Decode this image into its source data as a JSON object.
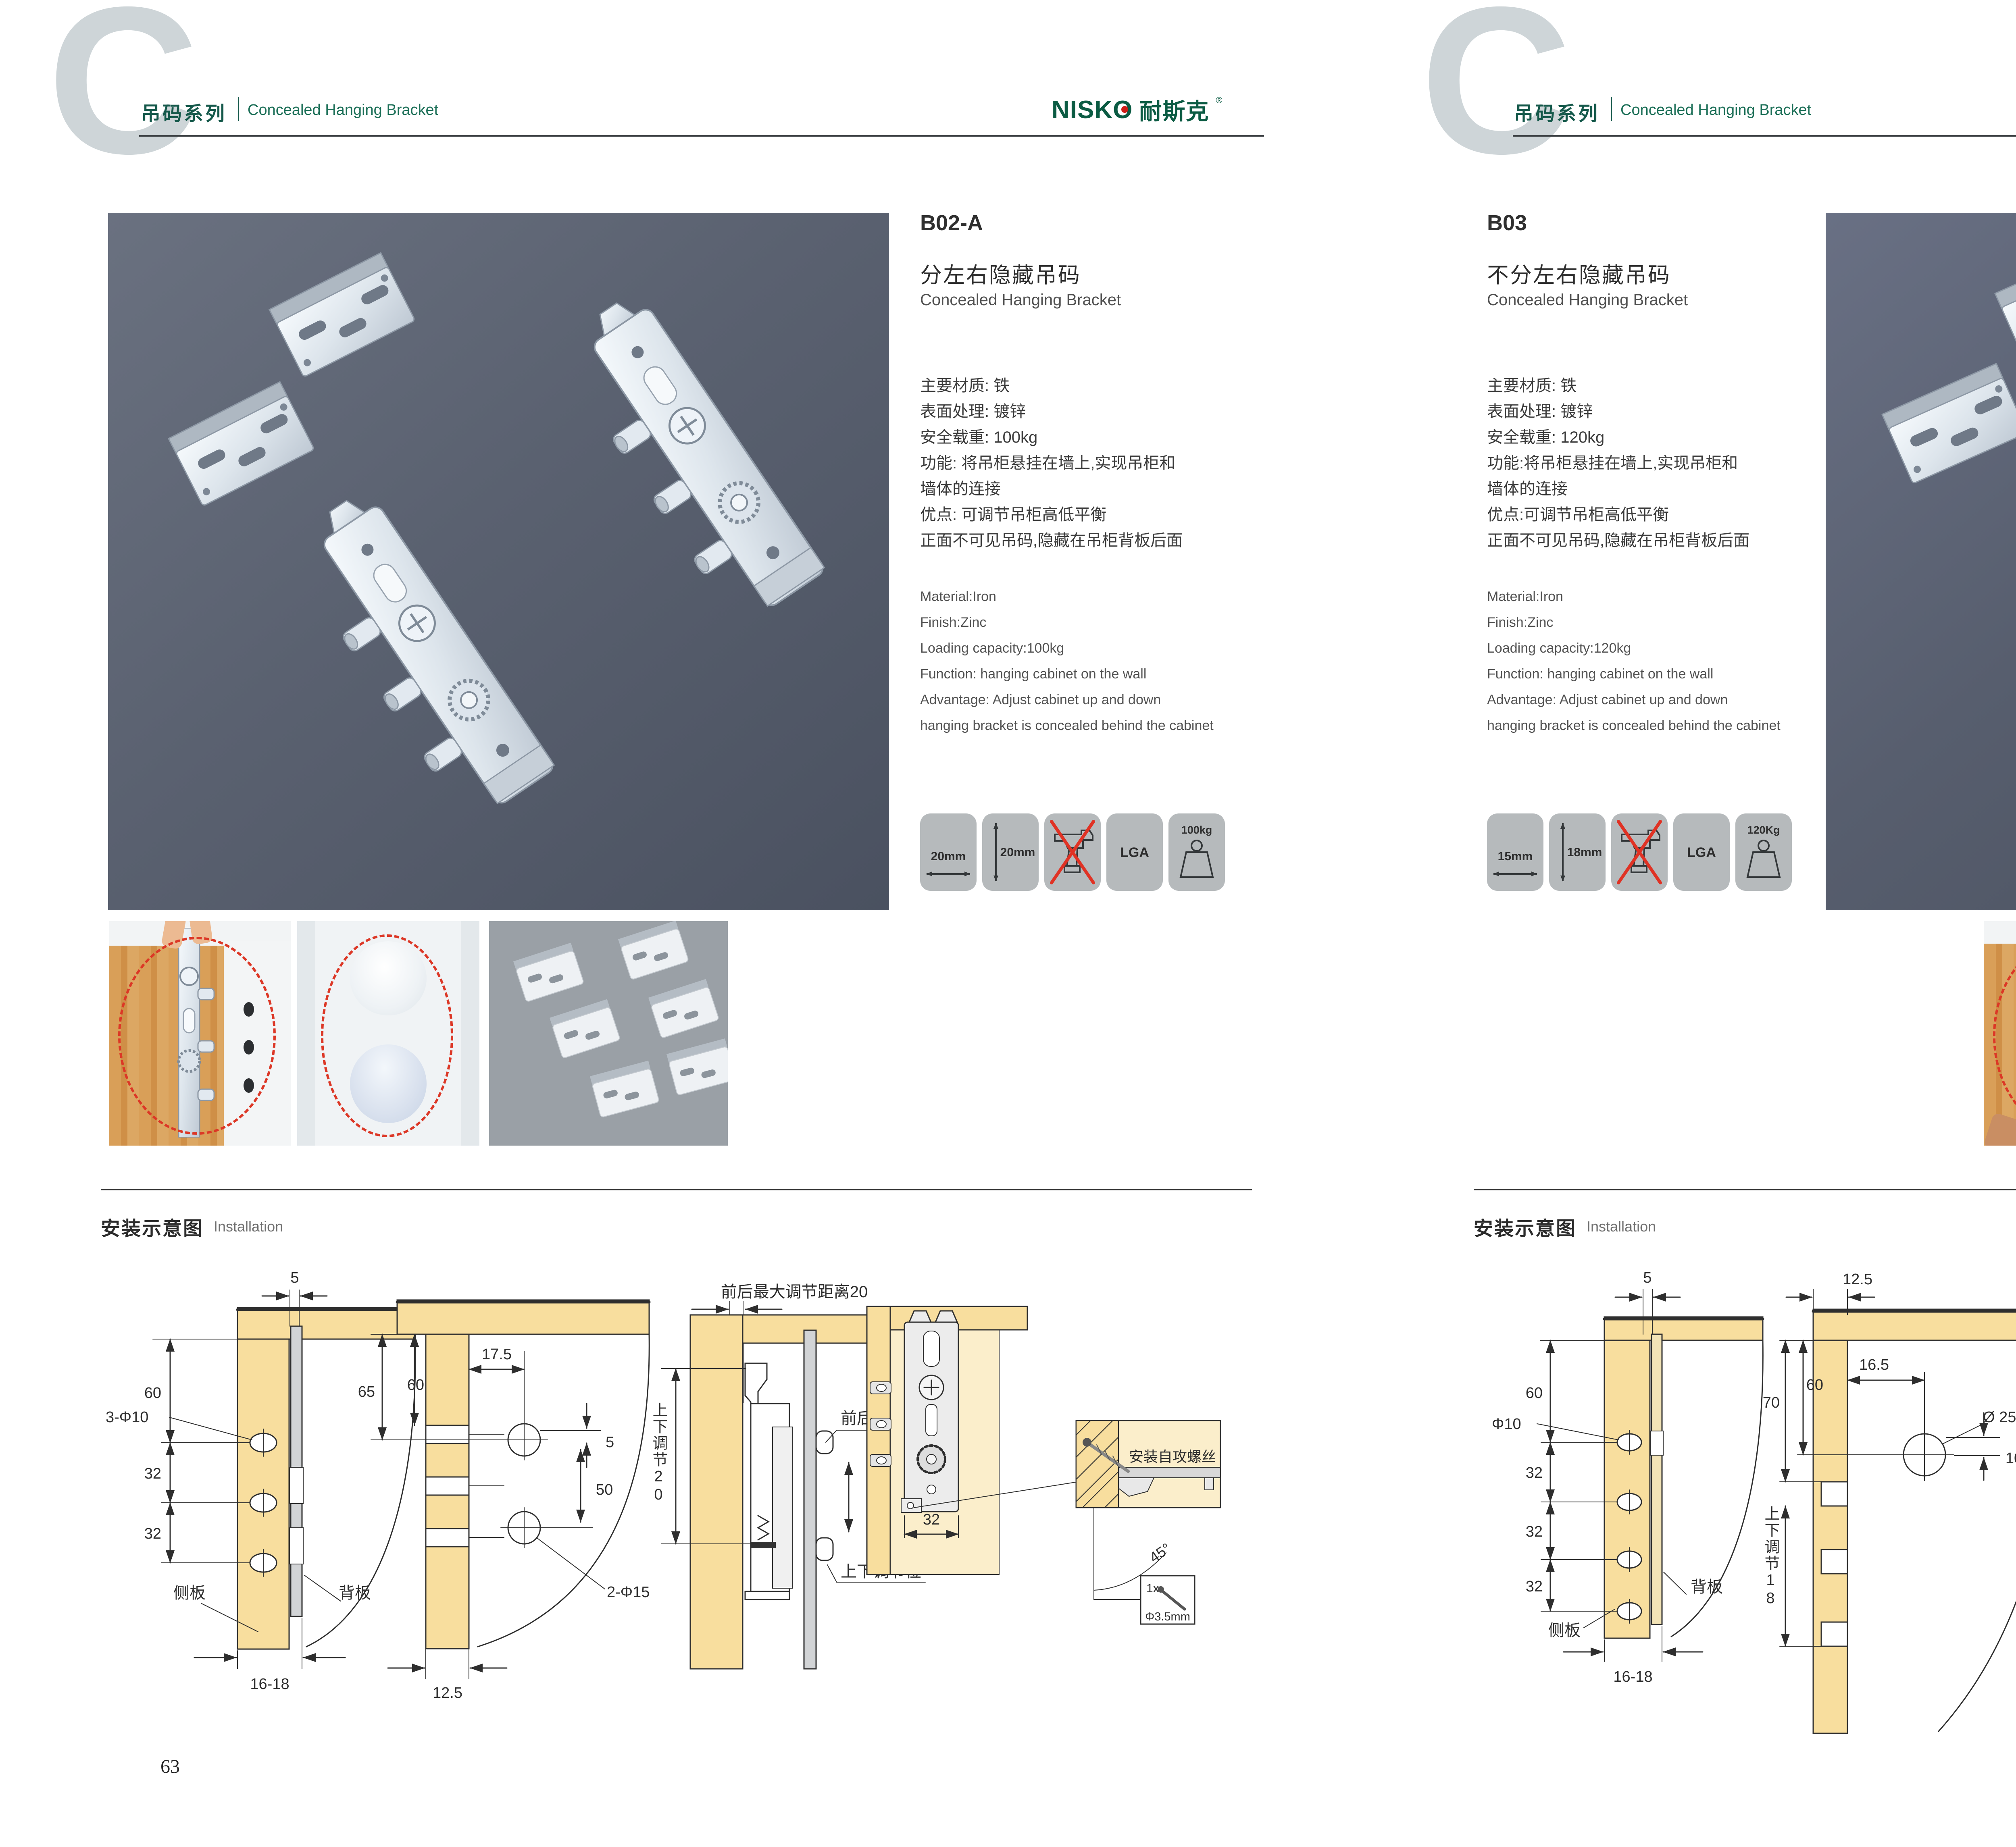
{
  "brand": {
    "logo_en": "NISKO",
    "logo_cn": "耐斯克",
    "reg": "®"
  },
  "header": {
    "letter": "C",
    "series_cn": "吊码系列",
    "series_en": "Concealed Hanging Bracket"
  },
  "install": {
    "title_cn": "安装示意图",
    "title_en": "Installation"
  },
  "left": {
    "page_number": "63",
    "model": "B02-A",
    "title_cn": "分左右隐藏吊码",
    "title_en": "Concealed Hanging Bracket",
    "specs_cn": [
      "主要材质: 铁",
      "表面处理: 镀锌",
      "安全载重: 100kg",
      "功能: 将吊柜悬挂在墙上,实现吊柜和",
      "墙体的连接",
      "优点: 可调节吊柜高低平衡",
      "正面不可见吊码,隐藏在吊柜背板后面"
    ],
    "specs_en": [
      "Material:Iron",
      "Finish:Zinc",
      "Loading capacity:100kg",
      "Function: hanging cabinet on the wall",
      "Advantage: Adjust cabinet up and down",
      "hanging bracket is concealed behind the cabinet"
    ],
    "icon_width": "20mm",
    "icon_height": "20mm",
    "icon_cert": "LGA",
    "icon_load": "100kg",
    "d1": {
      "top": "5",
      "h60": "60",
      "hole": "3-Φ10",
      "s1": "32",
      "s2": "32",
      "bottom": "16-18",
      "side": "侧板",
      "back": "背板"
    },
    "d2": {
      "h65": "65",
      "h60": "60",
      "w175": "17.5",
      "off5": "5",
      "h50": "50",
      "hole": "2-Φ15",
      "bottom": "12.5"
    },
    "d3": {
      "top": "前后最大调节距离20",
      "left": "上下调节20",
      "front": "前后调节位",
      "updown": "上下调节位"
    },
    "d4": {
      "w32": "32",
      "screw": "安装自攻螺丝",
      "angle": "45°",
      "qty": "1x",
      "dia": "Φ3.5mm"
    }
  },
  "right": {
    "page_number": "64",
    "model": "B03",
    "title_cn": "不分左右隐藏吊码",
    "title_en": "Concealed Hanging Bracket",
    "specs_cn": [
      "主要材质: 铁",
      "表面处理: 镀锌",
      "安全载重: 120kg",
      "功能:将吊柜悬挂在墙上,实现吊柜和",
      "墙体的连接",
      "优点:可调节吊柜高低平衡",
      "正面不可见吊码,隐藏在吊柜背板后面"
    ],
    "specs_en": [
      "Material:Iron",
      "Finish:Zinc",
      "Loading capacity:120kg",
      "Function: hanging cabinet on the wall",
      "Advantage: Adjust cabinet up and down",
      "hanging bracket is concealed behind the cabinet"
    ],
    "icon_width": "15mm",
    "icon_height": "18mm",
    "icon_cert": "LGA",
    "icon_load": "120Kg",
    "d1": {
      "top": "5",
      "h60": "60",
      "hole": "Φ10",
      "s1": "32",
      "s2": "32",
      "s3": "32",
      "bottom": "16-18",
      "side": "侧板",
      "back": "背板"
    },
    "d2": {
      "top": "12.5",
      "h70": "70",
      "h60": "60",
      "w165": "16.5",
      "dia": "Ø 25",
      "off10": "10",
      "left": "上下调节18"
    },
    "d3": {
      "top": "16.5",
      "w125": "12.5",
      "off10": "10",
      "dia": "ø25",
      "state": "锁紧状态"
    },
    "d4": {
      "screw": "安装自攻螺丝",
      "angle": "45°",
      "qty": "1x",
      "dia": "Φ3.5mm"
    }
  }
}
